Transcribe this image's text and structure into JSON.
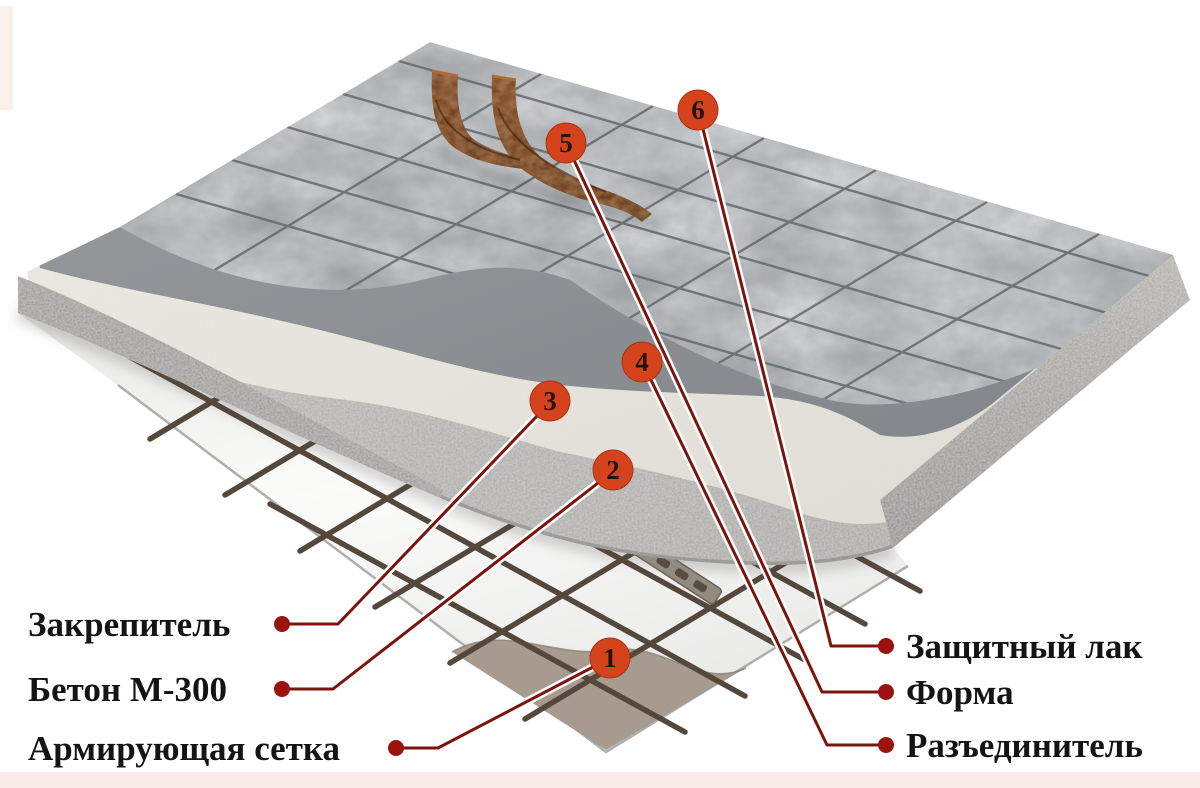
{
  "diagram": {
    "subject": "stamped-concrete-layer-structure",
    "language": "ru",
    "markers": [
      {
        "number": "1",
        "label": "Армирующая сетка",
        "side": "left"
      },
      {
        "number": "2",
        "label": "Бетон М-300",
        "side": "left"
      },
      {
        "number": "3",
        "label": "Закрепитель",
        "side": "left"
      },
      {
        "number": "4",
        "label": "Разъединитель",
        "side": "right"
      },
      {
        "number": "5",
        "label": "Форма",
        "side": "right"
      },
      {
        "number": "6",
        "label": "Защитный лак",
        "side": "right"
      }
    ],
    "colors": {
      "marker_fill": "#d5431c",
      "marker_edge": "#a93312",
      "marker_text": "#26120a",
      "leader_line": "#7c130c",
      "leader_halo": "#ffffff",
      "label_dot": "#9c120c",
      "label_text": "#141414",
      "tile_surface": "#a6aaad",
      "tile_joint": "#63686b",
      "hardener_band": "#8d9093",
      "cream_band": "#e9e7df",
      "concrete_band": "#b4b3af",
      "underlay_sheet": "#f4f4f2",
      "base_soil": "#a4968a",
      "mesh_rod": "#54483c",
      "stamp_mat": "#6e3a1c",
      "background_accent": "#f9ece8"
    }
  }
}
